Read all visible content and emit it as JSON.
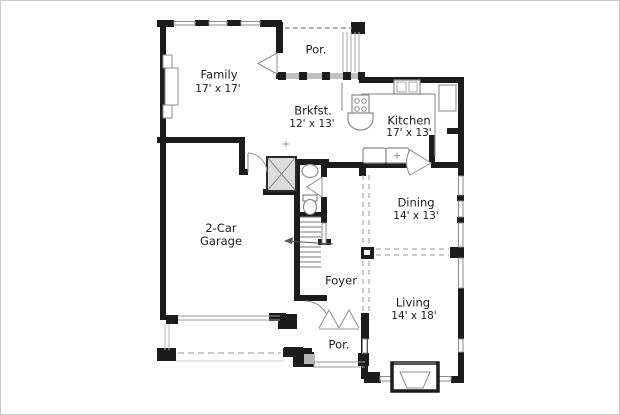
{
  "plan_title": "First floor plan",
  "rooms": {
    "family": {
      "label": "Family",
      "dims": "17' x 17'"
    },
    "porch_top": {
      "label": "Por."
    },
    "breakfast": {
      "label": "Brkfst.",
      "dims": "12' x 13'"
    },
    "kitchen": {
      "label": "Kitchen",
      "dims": "17' x 13'"
    },
    "dining": {
      "label": "Dining",
      "dims": "14' x 13'"
    },
    "garage": {
      "label_line1": "2-Car",
      "label_line2": "Garage"
    },
    "foyer": {
      "label": "Foyer"
    },
    "living": {
      "label": "Living",
      "dims": "14' x 18'"
    },
    "porch_bottom": {
      "label": "Por."
    }
  },
  "colors": {
    "wall": "#1c1c1c",
    "fixture_line": "#8c8c8c",
    "light_line": "#b5b5b5",
    "hatch_fill": "#dcdcdc",
    "background": "#ffffff",
    "text": "#1c1c1c"
  }
}
